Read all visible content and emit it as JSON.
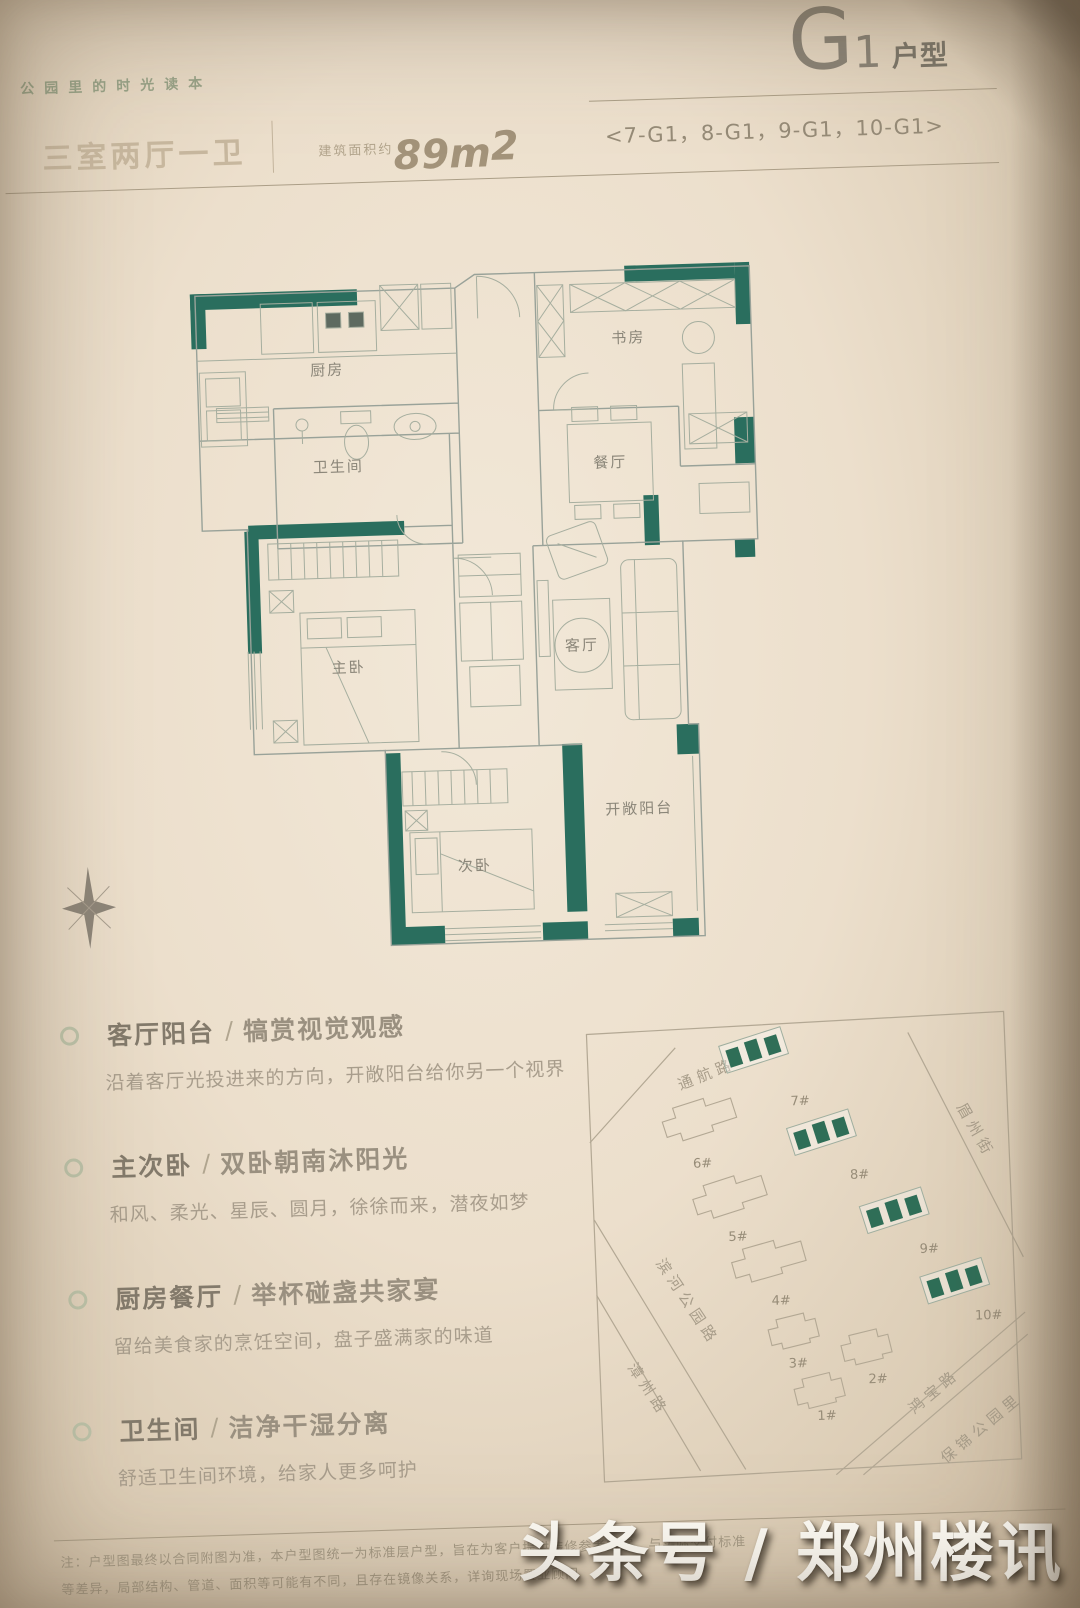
{
  "page": {
    "slogan": "公园里的时光读本",
    "unit_letter": "G",
    "unit_number": "1",
    "unit_suffix": "户型",
    "watermark": "头条号 / 郑州楼讯"
  },
  "header": {
    "layout": "三室两厅一卫",
    "area_label": "建筑面积约",
    "area_value": "89m",
    "area_sup": "2",
    "unit_list": "<7-G1，8-G1，9-G1，10-G1>"
  },
  "floorplan": {
    "rooms": {
      "kitchen": "厨房",
      "bath": "卫生间",
      "study": "书房",
      "dining": "餐厅",
      "living": "客厅",
      "master": "主卧",
      "second": "次卧",
      "balcony": "开敞阳台"
    },
    "wall_color": "#2a6e5e"
  },
  "features": {
    "divider": "/",
    "items": [
      {
        "title": "客厅阳台",
        "subtitle": "犒赏视觉观感",
        "desc": "沿着客厅光投进来的方向，开敞阳台给你另一个视界"
      },
      {
        "title": "主次卧",
        "subtitle": "双卧朝南沐阳光",
        "desc": "和风、柔光、星辰、圆月，徐徐而来，潜夜如梦"
      },
      {
        "title": "厨房餐厅",
        "subtitle": "举杯碰盏共家宴",
        "desc": "留给美食家的烹饪空间，盘子盛满家的味道"
      },
      {
        "title": "卫生间",
        "subtitle": "洁净干湿分离",
        "desc": "舒适卫生间环境，给家人更多呵护"
      }
    ]
  },
  "sitemap": {
    "roads": {
      "top": "通航路",
      "right": "眉州街",
      "park": "滨河公园路",
      "left": "漳州路",
      "bottom": "鸿宝路",
      "corner": "保锦公园里"
    },
    "buildings": [
      {
        "label": "1#",
        "highlight": false
      },
      {
        "label": "2#",
        "highlight": false
      },
      {
        "label": "3#",
        "highlight": false
      },
      {
        "label": "4#",
        "highlight": false
      },
      {
        "label": "5#",
        "highlight": false
      },
      {
        "label": "6#",
        "highlight": false
      },
      {
        "label": "7#",
        "highlight": true
      },
      {
        "label": "8#",
        "highlight": true
      },
      {
        "label": "9#",
        "highlight": true
      },
      {
        "label": "10#",
        "highlight": true
      }
    ]
  },
  "footnote": {
    "line1": "注：户型图最终以合同附图为准，本户型图统一为标准层户型，旨在为客户提供装修参考方案，与实际交付标准",
    "line2": "等差异，局部结构、管道、面积等可能有不同，且存在镜像关系，详询现场置业顾问"
  }
}
